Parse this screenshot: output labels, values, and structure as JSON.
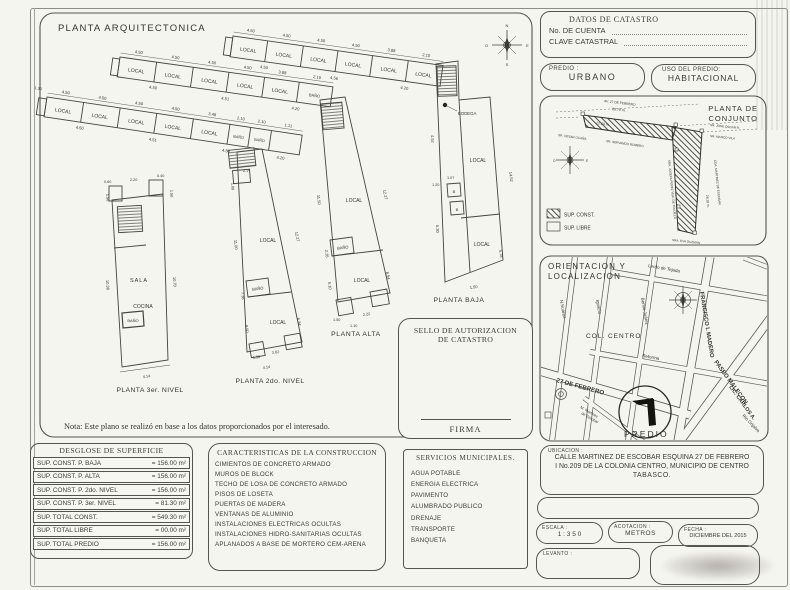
{
  "plan": {
    "title": "PLANTA ARQUITECTONICA",
    "note": "Nota: Este plano se realizó en base a los datos proporcionados por el interesado.",
    "rooms": {
      "local": "LOCAL",
      "bano": "BAÑO",
      "bodega": "BODEGA",
      "sala": "SALA",
      "cocina": "COCINA",
      "b": "B"
    },
    "floors": {
      "baja": "PLANTA BAJA",
      "alta": "PLANTA ALTA",
      "nivel2": "PLANTA 2do. NIVEL",
      "nivel3": "PLANTA 3er. NIVEL"
    },
    "compass": {
      "n": "N",
      "s": "S",
      "e": "E",
      "o": "O"
    },
    "dims": {
      "d450": "4.50",
      "d451": "4.51",
      "d456": "4.56",
      "d420": "4.20",
      "d388": "3.88",
      "d348": "3.48",
      "d210": "2.10",
      "d111": "1.11",
      "d214": "2.14",
      "d189": "1.89",
      "d130": "1.30",
      "d1150": "11.50",
      "d1227": "12.27",
      "d235": "2.35",
      "d854": "8.54",
      "d510": "5.10",
      "d150": "1.50",
      "d1452": "14.52",
      "d578": "5.78",
      "d860": "8.60",
      "d452": "4.52",
      "d630": "6.30",
      "d1100": "11.00",
      "d736": "7.36",
      "d850": "8.50",
      "d634": "6.34",
      "d060": "0.60",
      "d220": "2.20",
      "d040": "0.40",
      "d1038": "10.38",
      "d1070": "10.70",
      "d362": "3.62",
      "d222": "2.22",
      "d110": "1.10",
      "d414": "4.14",
      "d120": "1.20",
      "d107": "1.07",
      "d128": "1.28"
    }
  },
  "sello": {
    "line1": "SELLO DE AUTORIZACION",
    "line2": "DE CATASTRO",
    "firma": "FIRMA"
  },
  "catastro": {
    "title": "DATOS DE CATASTRO",
    "cuenta_label": "No. DE CUENTA",
    "clave_label": "CLAVE CATASTRAL"
  },
  "predio": {
    "label": "PREDIO :",
    "value": "URBANO"
  },
  "uso": {
    "label": "USO DEL PREDIO:",
    "value": "HABITACIONAL"
  },
  "conjunto": {
    "title_line1": "PLANTA DE",
    "title_line2": "CONJUNTO",
    "legend_const": "SUP. CONST.",
    "legend_libre": "SUP. LIBRE",
    "street_top": "AV. 27 DE FEBRERO",
    "dim_top": "28.70 m.",
    "dim_mid": "22.24 m.",
    "dim_side": "28.18 m.",
    "neighbor_1": "SR. CESAR OCAÑA",
    "neighbor_2": "SR. SERVANDO ROMERO",
    "neighbor_3": "SR. JOSE OSCAR R.",
    "neighbor_4": "SR. MARCO VILA",
    "side_left": "SRA. JOSEFA PEREZ VDA. DE TRUJILLO",
    "side_right": "CDA. MARTINEZ DE ESCOBAR",
    "bottom": "SRA. EVA GUZMAN"
  },
  "mapbox": {
    "title_line1": "ORIENTACION Y",
    "title_line2": "LOCALIZACION",
    "col_centro": "COL. CENTRO",
    "predio": "PREDIO",
    "streets": {
      "lerdo": "Lerdo de Tejada",
      "suarez": "N.Suarez",
      "ignacio": "Ignacio",
      "juarez": "Benito Juárez",
      "madero": "FRANCISCO I. MADERO",
      "reforma": "Reforma",
      "febrero": "27 DE FEBRERO",
      "escobar1": "M. Martinez",
      "escobar2": "de Escobar",
      "malecon": "PASEO MALECON",
      "carlos": "LIC. CARLOS A.",
      "grijalva": "Río Grijalva"
    }
  },
  "ubicacion": {
    "label": "UBICACION :",
    "line1": "CALLE MARTINEZ DE ESCOBAR ESQUINA 27 DE FEBRERO",
    "line2": "I No.209 DE LA COLONIA CENTRO, MUNICIPIO DE CENTRO",
    "line3": "TABASCO."
  },
  "escala": {
    "label": "ESCALA :",
    "value": "1 : 3 5 0"
  },
  "acotacion": {
    "label": "ACOTACION :",
    "value": "METROS"
  },
  "fecha": {
    "label": "FECHA :",
    "value": "DICIEMBRE DEL 2015"
  },
  "levanto": {
    "label": "LEVANTO :"
  },
  "desglose": {
    "title": "DESGLOSE DE SUPERFICIE",
    "rows": [
      {
        "label": "SUP. CONST. P. BAJA",
        "value": "= 156.00 m²"
      },
      {
        "label": "SUP. CONST. P. ALTA",
        "value": "= 156.00 m²"
      },
      {
        "label": "SUP. CONST. P. 2do. NIVEL",
        "value": "= 156.00 m²"
      },
      {
        "label": "SUP. CONST. P. 3er. NIVEL",
        "value": "= 81.30 m²"
      },
      {
        "label": "SUP. TOTAL CONST.",
        "value": "= 549.30 m²"
      },
      {
        "label": "SUP. TOTAL LIBRE",
        "value": "= 00.00 m²"
      },
      {
        "label": "SUP. TOTAL PREDIO",
        "value": "= 156.00 m²"
      }
    ]
  },
  "caracteristicas": {
    "title": "CARACTERISTICAS DE LA CONSTRUCCION",
    "items": [
      "CIMIENTOS DE CONCRETO ARMADO",
      "MUROS DE BLOCK",
      "TECHO DE LOSA DE CONCRETO ARMADO",
      "PISOS DE LOSETA",
      "PUERTAS DE MADERA",
      "VENTANAS DE ALUMINIO",
      "INSTALACIONES ELECTRICAS OCULTAS",
      "INSTALACIONES HIDRO-SANITARIAS OCULTAS",
      "APLANADOS A BASE DE MORTERO CEM-ARENA"
    ]
  },
  "servicios": {
    "title": "SERVICIOS MUNICIPALES.",
    "items": [
      "AGUA POTABLE",
      "ENERGIA ELECTRICA",
      "PAVIMENTO",
      "ALUMBRADO PUBLICO",
      "DRENAJE",
      "TRANSPORTE",
      "BANQUETA"
    ]
  }
}
